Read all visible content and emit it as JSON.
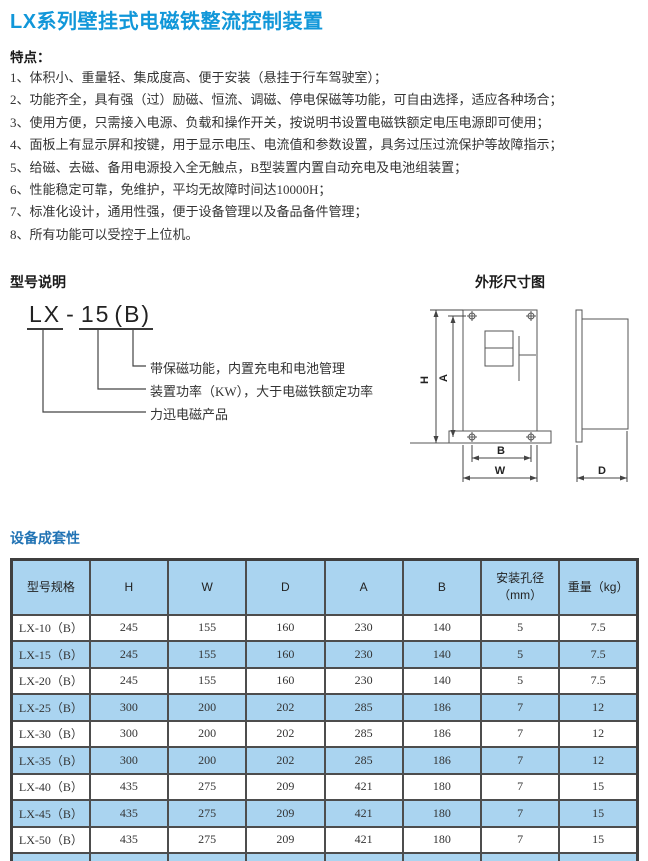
{
  "page_title": "LX系列壁挂式电磁铁整流控制装置",
  "features": {
    "heading": "特点：",
    "items": [
      "1、体积小、重量轻、集成度高、便于安装（悬挂于行车驾驶室）；",
      "2、功能齐全，具有强（过）励磁、恒流、调磁、停电保磁等功能，可自由选择，适应各种场合；",
      "3、使用方便，只需接入电源、负载和操作开关，按说明书设置电磁铁额定电压电源即可使用；",
      "4、面板上有显示屏和按键，用于显示电压、电流值和参数设置，具务过压过流保护等故障指示；",
      "5、给磁、去磁、备用电源投入全无触点，B型装置内置自动充电及电池组装置；",
      "6、性能稳定可靠，免维护，平均无故障时间达10000H；",
      "7、标准化设计，通用性强，便于设备管理以及备品备件管理；",
      "8、所有功能可以受控于上位机。"
    ]
  },
  "model": {
    "heading": "型号说明",
    "code": {
      "series": "LX",
      "dash": "-",
      "power": "15",
      "variant": "(B)"
    },
    "callouts": [
      "带保磁功能，内置充电和电池管理",
      "装置功率（KW），大于电磁铁额定功率",
      "力迅电磁产品"
    ]
  },
  "drawing": {
    "heading": "外形尺寸图",
    "labels": {
      "h": "H",
      "a": "A",
      "b": "B",
      "w": "W",
      "d": "D"
    }
  },
  "spec_table": {
    "heading": "设备成套性",
    "columns": [
      "型号规格",
      "H",
      "W",
      "D",
      "A",
      "B",
      "安装孔径\n（mm）",
      "重量（kg）"
    ],
    "rows": [
      [
        "LX-10（B）",
        "245",
        "155",
        "160",
        "230",
        "140",
        "5",
        "7.5"
      ],
      [
        "LX-15（B）",
        "245",
        "155",
        "160",
        "230",
        "140",
        "5",
        "7.5"
      ],
      [
        "LX-20（B）",
        "245",
        "155",
        "160",
        "230",
        "140",
        "5",
        "7.5"
      ],
      [
        "LX-25（B）",
        "300",
        "200",
        "202",
        "285",
        "186",
        "7",
        "12"
      ],
      [
        "LX-30（B）",
        "300",
        "200",
        "202",
        "285",
        "186",
        "7",
        "12"
      ],
      [
        "LX-35（B）",
        "300",
        "200",
        "202",
        "285",
        "186",
        "7",
        "12"
      ],
      [
        "LX-40（B）",
        "435",
        "275",
        "209",
        "421",
        "180",
        "7",
        "15"
      ],
      [
        "LX-45（B）",
        "435",
        "275",
        "209",
        "421",
        "180",
        "7",
        "15"
      ],
      [
        "LX-50（B）",
        "435",
        "275",
        "209",
        "421",
        "180",
        "7",
        "15"
      ]
    ]
  },
  "colors": {
    "title_blue": "#1197d9",
    "section_blue": "#2173b4",
    "table_row_blue": "#aad4f0",
    "border_dark": "#4d4d4d"
  }
}
